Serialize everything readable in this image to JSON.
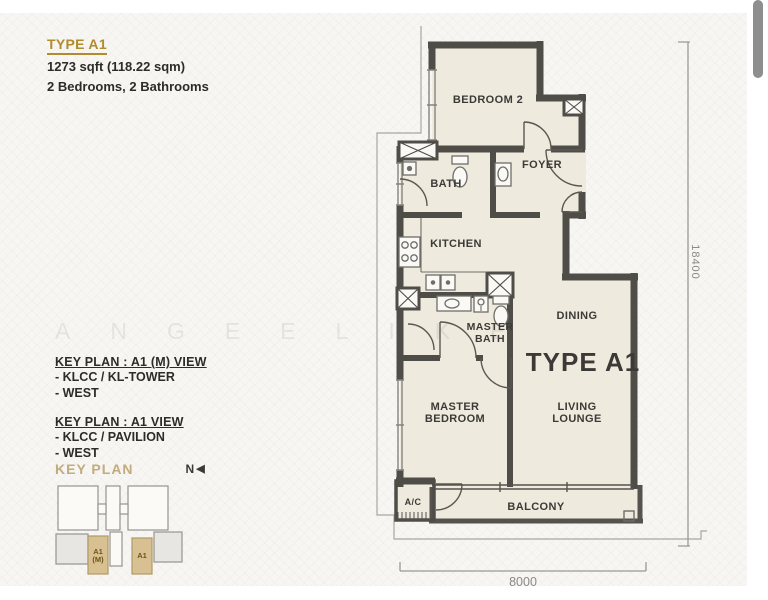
{
  "header": {
    "title": "TYPE A1",
    "area": "1273 sqft (118.22 sqm)",
    "rooms": "2 Bedrooms, 2 Bathrooms"
  },
  "key_plans": [
    {
      "title": "KEY PLAN : A1 (M) VIEW",
      "items": [
        "- KLCC / KL-TOWER",
        "- WEST"
      ]
    },
    {
      "title": "KEY PLAN : A1 VIEW",
      "items": [
        "- KLCC / PAVILION",
        "- WEST"
      ]
    }
  ],
  "key_plan_map": {
    "label": "KEY PLAN",
    "north": "N",
    "unit_a1m_line1": "A1",
    "unit_a1m_line2": "(M)",
    "unit_a1": "A1"
  },
  "floor_plan": {
    "unit_label": "TYPE A1",
    "labels": {
      "bedroom2": "BEDROOM 2",
      "foyer": "FOYER",
      "bath": "BATH",
      "kitchen": "KITCHEN",
      "master_bath": [
        "MASTER",
        "BATH"
      ],
      "dining": "DINING",
      "master_bedroom": [
        "MASTER",
        "BEDROOM"
      ],
      "living_lounge": [
        "LIVING",
        "LOUNGE"
      ],
      "balcony": "BALCONY",
      "ac": "A/C"
    },
    "dimensions": {
      "width_mm": "8000",
      "height_mm": "18400"
    }
  },
  "watermark": "ANGEELIKE",
  "colors": {
    "accent_gold": "#b28b2b",
    "keyplan_tan": "#d9c092",
    "wall": "#4f4d48",
    "floor": "#eeeade"
  }
}
